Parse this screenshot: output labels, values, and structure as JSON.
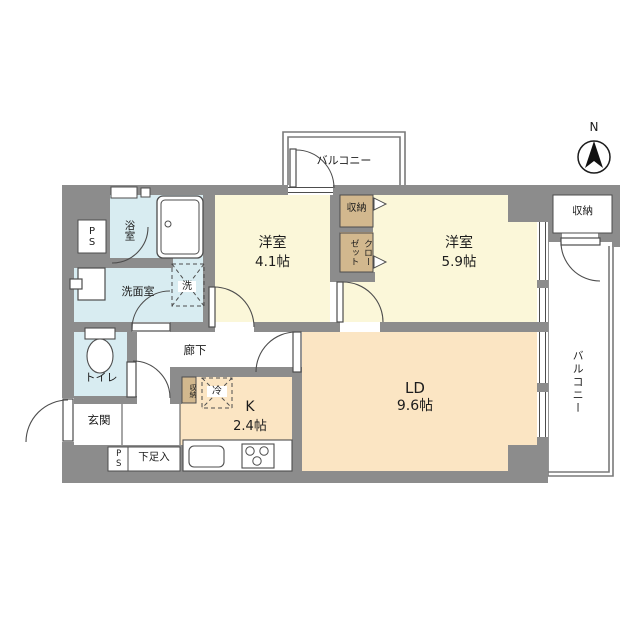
{
  "plan_type": "apartment-floor-plan",
  "compass": {
    "north_label": "N"
  },
  "labels": {
    "balcony_top": "バルコニー",
    "balcony_right": "バルコニー",
    "room1_name": "洋室",
    "room1_size": "4.1帖",
    "room2_name": "洋室",
    "room2_size": "5.9帖",
    "ld_name": "LD",
    "ld_size": "9.6帖",
    "kitchen_name": "K",
    "kitchen_size": "2.4帖",
    "bath": "浴室",
    "washroom": "洗面室",
    "washer": "洗",
    "toilet": "トイレ",
    "genkan": "玄関",
    "corridor": "廊下",
    "closet_upper": "収納",
    "closet_lower": "クローゼット",
    "storage_top_right": "収納",
    "storage_kitchen": "収納",
    "fridge": "冷",
    "shoe_cabinet": "下足入",
    "pipe_space_top": "PS",
    "pipe_space_bottom": "PS"
  },
  "colors": {
    "wall": "#8c8c8c",
    "western_room": "#fbf7d9",
    "living_kitchen": "#fbe5c3",
    "wet_area": "#d8ecf1",
    "closet": "#d2b88e",
    "outline": "#4d4d4d"
  }
}
